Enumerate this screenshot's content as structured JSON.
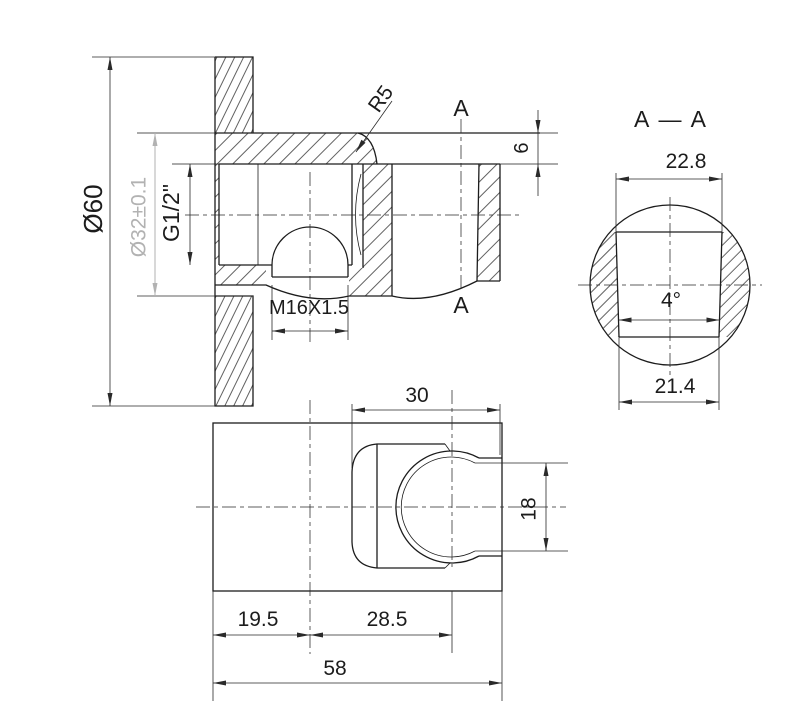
{
  "colors": {
    "bg": "#ffffff",
    "line": "#1c1c1c",
    "dim": "#2a2a2a",
    "gray_dim": "#b2b2b2"
  },
  "front_view": {
    "dim_outer_diameter": "Ø60",
    "dim_escutcheon_bore": "Ø32±0.1",
    "dim_thread": "G1/2\"",
    "dim_fillet_radius": "R5",
    "dim_plate_thickness": "6",
    "dim_bottom_thread": "M16X1.5",
    "section_label_top": "A",
    "section_label_bottom": "A"
  },
  "section_view": {
    "title": "A — A",
    "dim_top_width": "22.8",
    "dim_taper_angle": "4°",
    "dim_bottom_width": "21.4"
  },
  "top_view": {
    "dim_cup_width": "30",
    "dim_opening_height": "18",
    "dim_left_offset": "19.5",
    "dim_cup_center_offset": "28.5",
    "dim_total_length": "58"
  }
}
